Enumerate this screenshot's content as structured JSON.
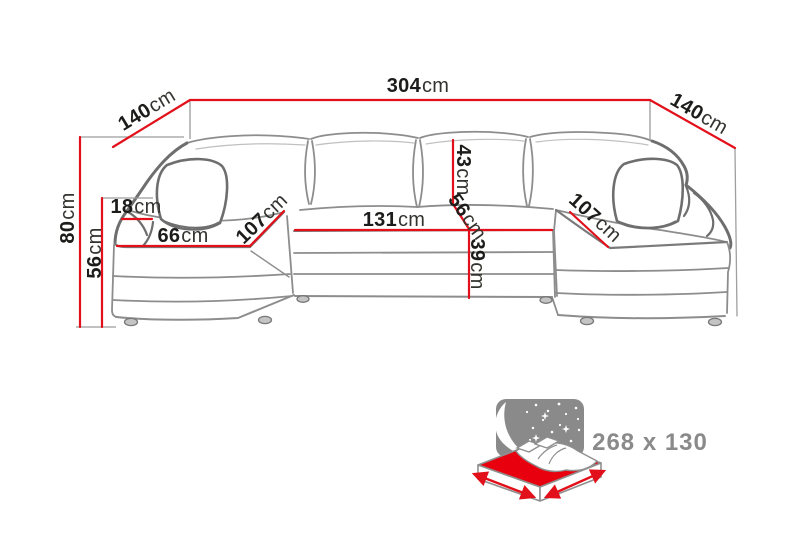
{
  "diagram": {
    "type": "sofa-dimension-diagram",
    "dims": {
      "total_width": {
        "value": "304",
        "unit": "cm"
      },
      "left_side_depth": {
        "value": "140",
        "unit": "cm"
      },
      "right_side_depth": {
        "value": "140",
        "unit": "cm"
      },
      "overall_height": {
        "value": "80",
        "unit": "cm"
      },
      "seat_height": {
        "value": "56",
        "unit": "cm"
      },
      "armrest_width": {
        "value": "18",
        "unit": "cm"
      },
      "chaise_seat_width": {
        "value": "66",
        "unit": "cm"
      },
      "left_chaise_length": {
        "value": "107",
        "unit": "cm"
      },
      "middle_seat_width": {
        "value": "131",
        "unit": "cm"
      },
      "backrest_cushion_height": {
        "value": "43",
        "unit": "cm"
      },
      "seat_depth": {
        "value": "56",
        "unit": "cm"
      },
      "base_height": {
        "value": "39",
        "unit": "cm"
      },
      "right_chaise_length": {
        "value": "107",
        "unit": "cm"
      }
    },
    "sleeping_area": {
      "label": "268 x 130"
    },
    "colors": {
      "dimension_red": "#e2101a",
      "mattress_red": "#e8000e",
      "outline_gray": "#8d8d8d",
      "text_dark": "#1c1c1a",
      "sleep_text_gray": "#8a8a8a"
    }
  }
}
